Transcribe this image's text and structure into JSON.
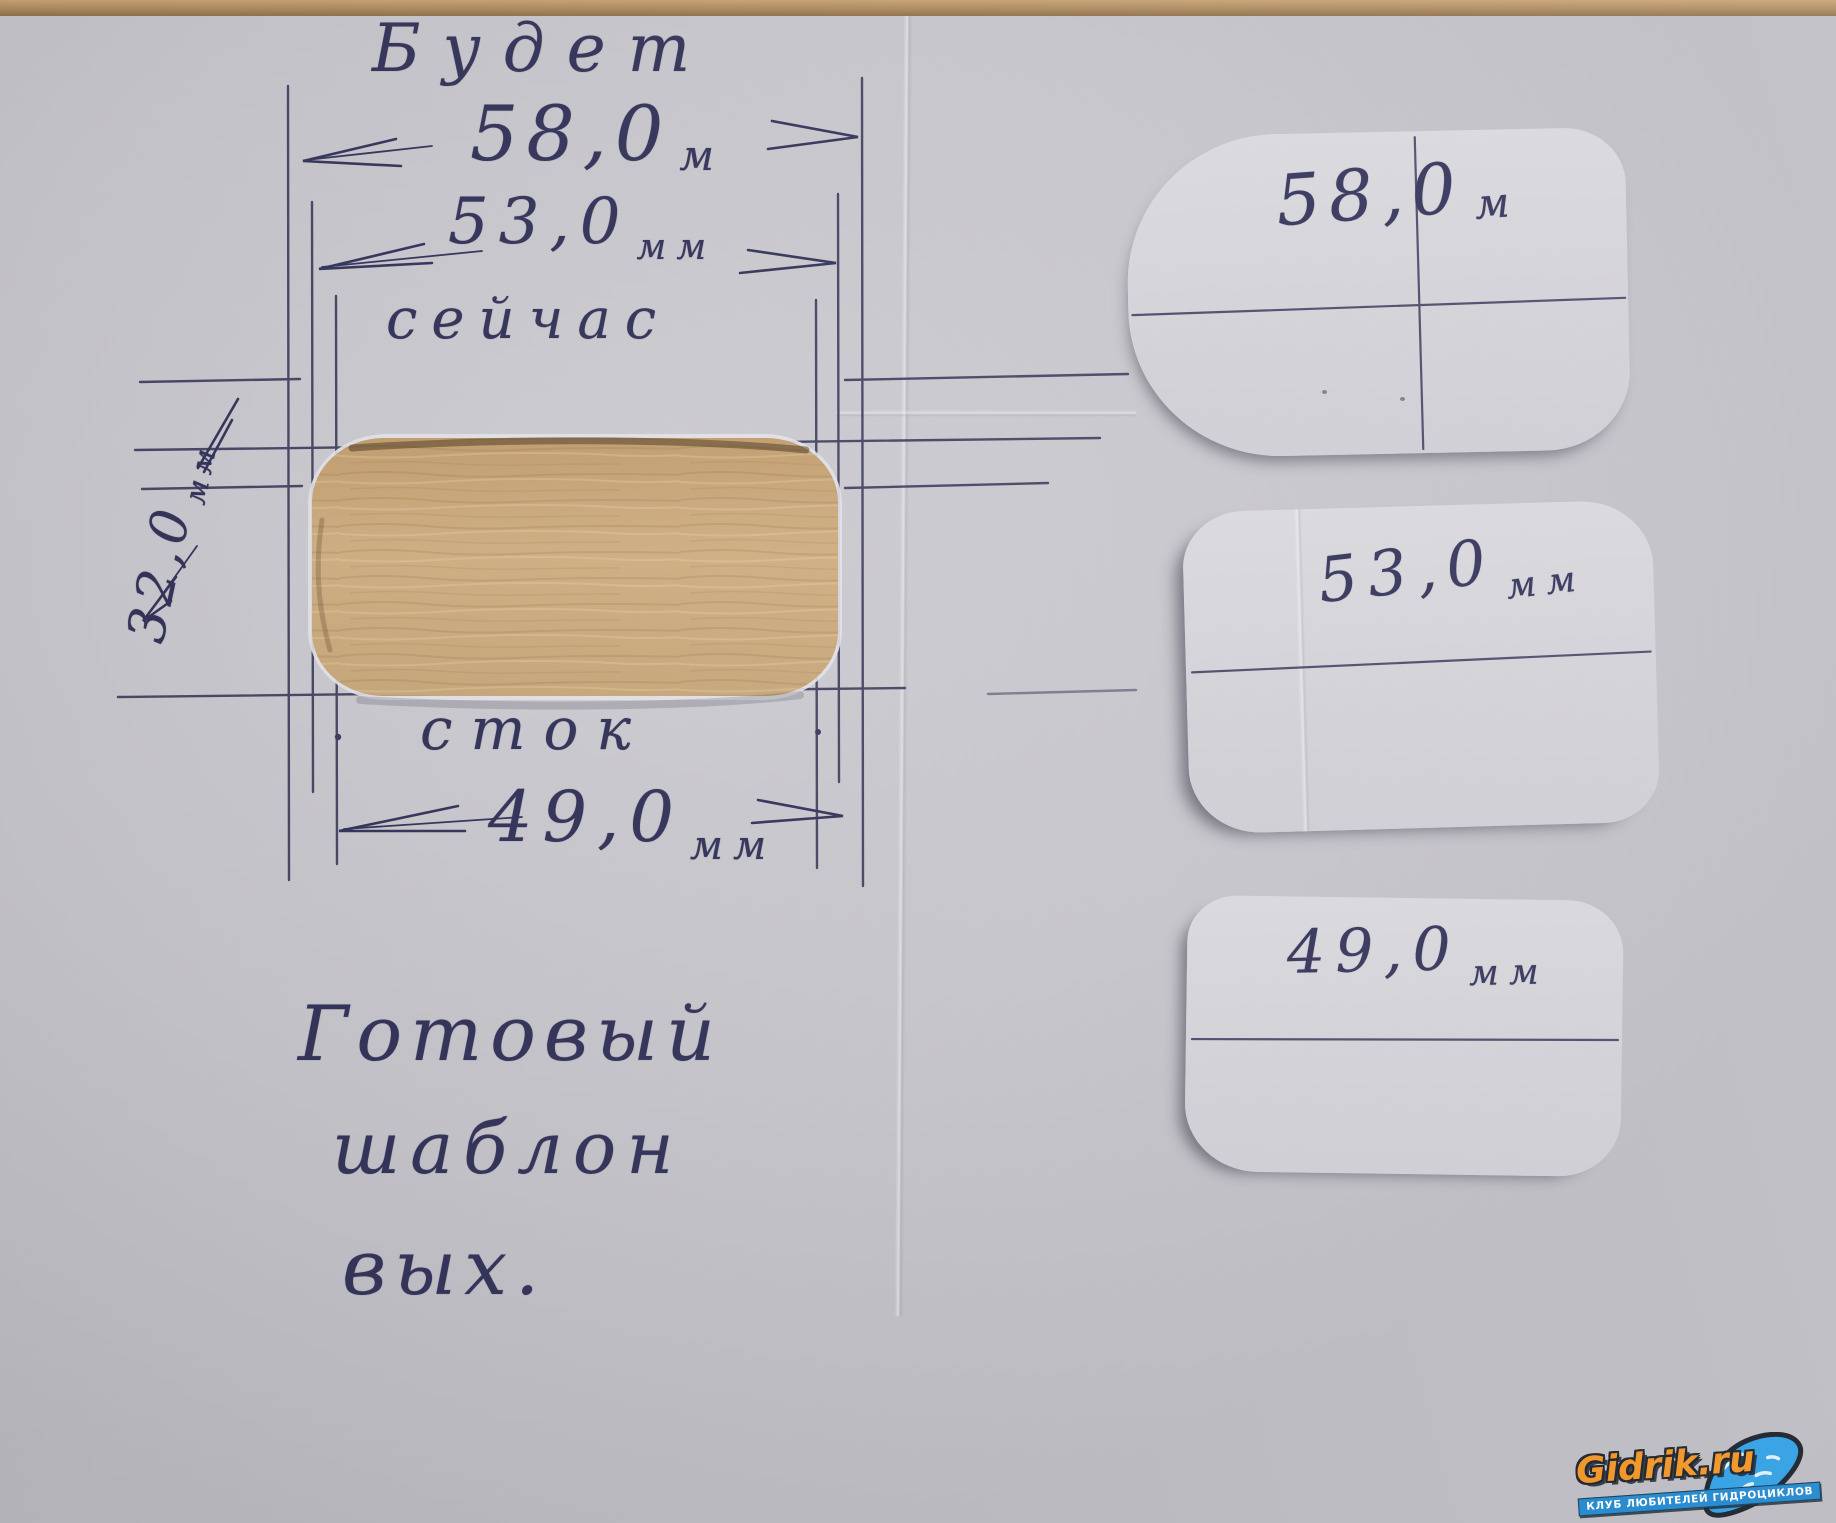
{
  "photo": {
    "colors": {
      "ink": "#34345c",
      "paper": "#cac9cf",
      "wood": "#cfae80",
      "table": "#b08c5f",
      "watermark_orange": "#f5921e",
      "watermark_blue": "#1b86cf"
    }
  },
  "sketch": {
    "label_will_be": "Будет",
    "dim_58": {
      "value": "58,0",
      "unit": "м"
    },
    "dim_53": {
      "value": "53,0",
      "unit": "мм"
    },
    "label_now": "сейчас",
    "dim_32": {
      "value": "32,0",
      "unit": "мм"
    },
    "label_stock": "сток",
    "dim_49": {
      "value": "49,0",
      "unit": "мм"
    },
    "caption": {
      "line1": "Готовый",
      "line2": "шаблон",
      "line3": "вых."
    }
  },
  "templates": [
    {
      "value": "58,0",
      "unit": "м"
    },
    {
      "value": "53,0",
      "unit": "мм"
    },
    {
      "value": "49,0",
      "unit": "мм"
    }
  ],
  "watermark": {
    "title": "Gidrik.ru",
    "subtitle": "КЛУБ ЛЮБИТЕЛЕЙ ГИДРОЦИКЛОВ"
  }
}
